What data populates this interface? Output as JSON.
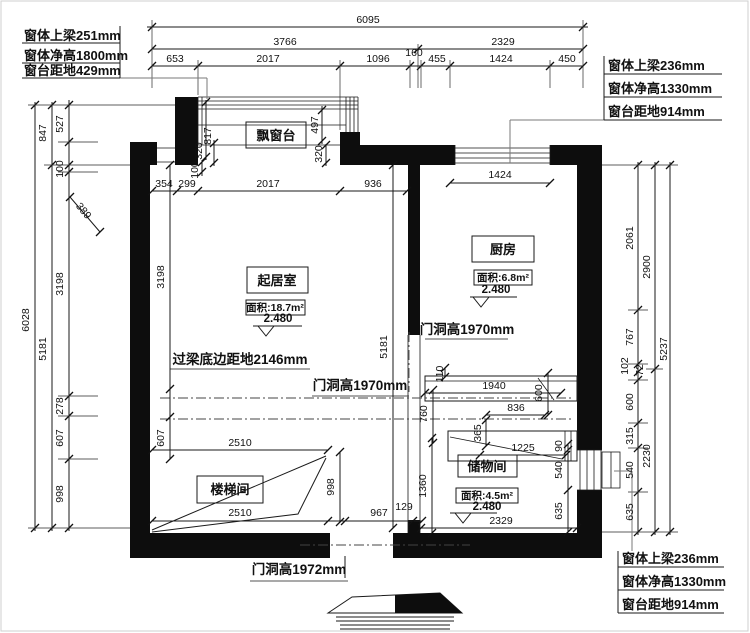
{
  "drawing": {
    "window_labels": {
      "top_left": [
        "窗体上梁251mm",
        "窗体净高1800mm",
        "窗台距地429mm"
      ],
      "top_right": [
        "窗体上梁236mm",
        "窗体净高1330mm",
        "窗台距地914mm"
      ],
      "bottom_right": [
        "窗体上梁236mm",
        "窗体净高1330mm",
        "窗台距地914mm"
      ]
    },
    "rooms": {
      "bay_window": {
        "name": "飘窗台"
      },
      "living_room": {
        "name": "起居室",
        "area": "面积:18.7m²",
        "level": "2.480"
      },
      "kitchen": {
        "name": "厨房",
        "area": "面积:6.8m²",
        "level": "2.480"
      },
      "storage": {
        "name": "储物间",
        "area": "面积:4.5m²",
        "level": "2.480"
      },
      "stairwell": {
        "name": "楼梯间"
      }
    },
    "annotations": {
      "lintel_note": "过梁底边距地2146mm",
      "door_living": "门洞高1970mm",
      "door_kitchen": "门洞高1970mm",
      "door_bottom": "门洞高1972mm"
    },
    "colors": {
      "line": "#1a1a1a",
      "wall": "#0d0d0d",
      "leader": "#7a7a7a",
      "background": "#ffffff"
    }
  },
  "dimensions": [
    {
      "t": "6095",
      "x": 368,
      "y": 23,
      "r": 0
    },
    {
      "t": "3766",
      "x": 285,
      "y": 45,
      "r": 0
    },
    {
      "t": "2329",
      "x": 503,
      "y": 45,
      "r": 0
    },
    {
      "t": "653",
      "x": 175,
      "y": 62,
      "r": 0
    },
    {
      "t": "2017",
      "x": 268,
      "y": 62,
      "r": 0
    },
    {
      "t": "1096",
      "x": 378,
      "y": 62,
      "r": 0
    },
    {
      "t": "160",
      "x": 414,
      "y": 56,
      "r": 0
    },
    {
      "t": "455",
      "x": 437,
      "y": 62,
      "r": 0
    },
    {
      "t": "1424",
      "x": 501,
      "y": 62,
      "r": 0
    },
    {
      "t": "450",
      "x": 567,
      "y": 62,
      "r": 0
    },
    {
      "t": "847",
      "x": 46,
      "y": 133,
      "r": -90
    },
    {
      "t": "527",
      "x": 63,
      "y": 124,
      "r": -90
    },
    {
      "t": "100",
      "x": 63,
      "y": 169,
      "r": -90
    },
    {
      "t": "389",
      "x": 81,
      "y": 213,
      "r": 50
    },
    {
      "t": "3198",
      "x": 63,
      "y": 284,
      "r": -90
    },
    {
      "t": "5181",
      "x": 46,
      "y": 349,
      "r": -90
    },
    {
      "t": "6028",
      "x": 29,
      "y": 320,
      "r": -90
    },
    {
      "t": "278",
      "x": 63,
      "y": 406,
      "r": -90
    },
    {
      "t": "607",
      "x": 63,
      "y": 438,
      "r": -90
    },
    {
      "t": "998",
      "x": 63,
      "y": 494,
      "r": -90
    },
    {
      "t": "2061",
      "x": 633,
      "y": 238,
      "r": -90
    },
    {
      "t": "767",
      "x": 633,
      "y": 337,
      "r": -90
    },
    {
      "t": "102",
      "x": 628,
      "y": 366,
      "r": -90
    },
    {
      "t": "72",
      "x": 643,
      "y": 370,
      "r": -90
    },
    {
      "t": "600",
      "x": 633,
      "y": 402,
      "r": -90
    },
    {
      "t": "315",
      "x": 633,
      "y": 436,
      "r": -90
    },
    {
      "t": "540",
      "x": 633,
      "y": 470,
      "r": -90
    },
    {
      "t": "635",
      "x": 633,
      "y": 512,
      "r": -90
    },
    {
      "t": "2900",
      "x": 650,
      "y": 267,
      "r": -90
    },
    {
      "t": "2230",
      "x": 650,
      "y": 456,
      "r": -90
    },
    {
      "t": "5237",
      "x": 667,
      "y": 349,
      "r": -90
    },
    {
      "t": "354",
      "x": 164,
      "y": 187,
      "r": 0
    },
    {
      "t": "299",
      "x": 187,
      "y": 187,
      "r": 0
    },
    {
      "t": "2017",
      "x": 268,
      "y": 187,
      "r": 0
    },
    {
      "t": "936",
      "x": 373,
      "y": 187,
      "r": 0
    },
    {
      "t": "1424",
      "x": 500,
      "y": 178,
      "r": 0
    },
    {
      "t": "817",
      "x": 211,
      "y": 136,
      "r": -90
    },
    {
      "t": "320",
      "x": 202,
      "y": 151,
      "r": -90
    },
    {
      "t": "100",
      "x": 198,
      "y": 170,
      "r": -90
    },
    {
      "t": "497",
      "x": 318,
      "y": 125,
      "r": -90
    },
    {
      "t": "320",
      "x": 322,
      "y": 154,
      "r": -90
    },
    {
      "t": "3198",
      "x": 164,
      "y": 277,
      "r": -90
    },
    {
      "t": "607",
      "x": 164,
      "y": 438,
      "r": -90
    },
    {
      "t": "5181",
      "x": 387,
      "y": 347,
      "r": -90
    },
    {
      "t": "110",
      "x": 443,
      "y": 374,
      "r": -90
    },
    {
      "t": "1940",
      "x": 494,
      "y": 389,
      "r": 0
    },
    {
      "t": "760",
      "x": 427,
      "y": 414,
      "r": -90
    },
    {
      "t": "836",
      "x": 516,
      "y": 411,
      "r": 0
    },
    {
      "t": "600",
      "x": 542,
      "y": 393,
      "r": -90
    },
    {
      "t": "365",
      "x": 481,
      "y": 433,
      "r": -90
    },
    {
      "t": "1225",
      "x": 523,
      "y": 451,
      "r": 0
    },
    {
      "t": "90",
      "x": 562,
      "y": 446,
      "r": -90
    },
    {
      "t": "540",
      "x": 562,
      "y": 470,
      "r": -90
    },
    {
      "t": "635",
      "x": 562,
      "y": 511,
      "r": -90
    },
    {
      "t": "1360",
      "x": 426,
      "y": 486,
      "r": -90
    },
    {
      "t": "2510",
      "x": 240,
      "y": 446,
      "r": 0
    },
    {
      "t": "2510",
      "x": 240,
      "y": 516,
      "r": 0
    },
    {
      "t": "967",
      "x": 379,
      "y": 516,
      "r": 0
    },
    {
      "t": "129",
      "x": 404,
      "y": 510,
      "r": 0
    },
    {
      "t": "998",
      "x": 334,
      "y": 487,
      "r": -90
    },
    {
      "t": "2329",
      "x": 501,
      "y": 524,
      "r": 0
    }
  ]
}
